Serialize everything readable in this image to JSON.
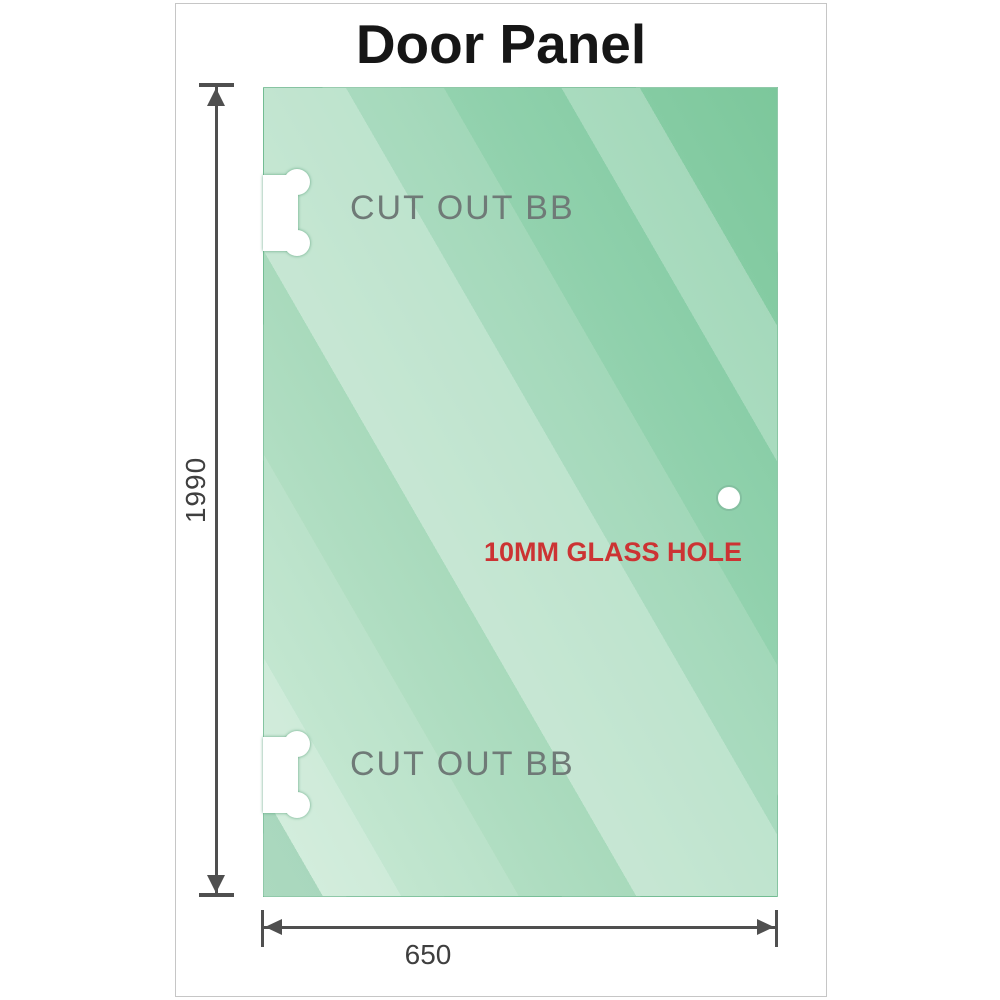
{
  "diagram": {
    "title": "Door Panel",
    "cutouts": [
      {
        "label": "CUT OUT BB"
      },
      {
        "label": "CUT OUT BB"
      }
    ],
    "glass_hole": {
      "label": "10MM GLASS HOLE",
      "label_color": "#cc3333"
    },
    "dimensions": {
      "height": {
        "value": "1990"
      },
      "width": {
        "value": "650"
      }
    },
    "colors": {
      "glass_light": "#c3e7d0",
      "glass_dark": "#7cc79b",
      "dimension_lines": "#4f4f4f",
      "cutout_label": "#6f7a77",
      "card_border": "#c6c6c6"
    }
  }
}
